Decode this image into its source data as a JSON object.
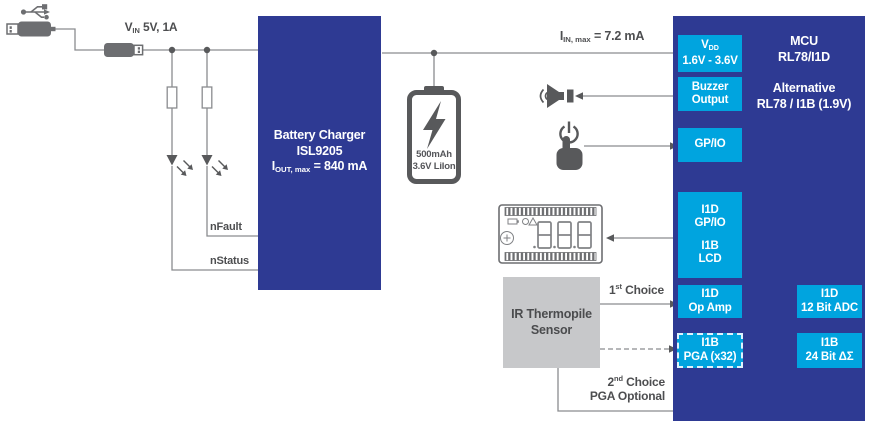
{
  "colors": {
    "block_blue": "#2e3a93",
    "accent_cyan": "#00a4df",
    "sensor_gray": "#c7c8ca",
    "wire_gray": "#8a8c8f",
    "icon_gray": "#58595b",
    "label_gray": "#4d4e50"
  },
  "input": {
    "vin_base": "V",
    "vin_sub": "IN",
    "vin_rest": " 5V, 1A"
  },
  "rail": {
    "iin_base": "I",
    "iin_sub": "IN, max",
    "iin_rest": " = 7.2 mA"
  },
  "charger": {
    "title": "Battery Charger",
    "part": "ISL9205",
    "iout_base": "I",
    "iout_sub": "OUT, max",
    "iout_rest": " = 840 mA",
    "nfault": "nFault",
    "nstatus": "nStatus"
  },
  "battery": {
    "capacity": "500mAh",
    "chemistry": "3.6V LiIon"
  },
  "mcu": {
    "title": "MCU",
    "part": "RL78/I1D",
    "alt_label": "Alternative",
    "alt_part": "RL78 / I1B (1.9V)",
    "vdd_base": "V",
    "vdd_sub": "DD",
    "vdd_range": "1.6V - 3.6V",
    "buzzer_l1": "Buzzer",
    "buzzer_l2": "Output",
    "gpio": "GP/IO",
    "lcd_l1": "I1D",
    "lcd_l2": "GP/IO",
    "lcd_l3": "I1B",
    "lcd_l4": "LCD",
    "opamp_l1": "I1D",
    "opamp_l2": "Op Amp",
    "adc_l1": "I1D",
    "adc_l2": "12 Bit ADC",
    "pga_l1": "I1B",
    "pga_l2": "PGA (x32)",
    "dsm_l1": "I1B",
    "dsm_l2": "24 Bit ΔΣ"
  },
  "sensor": {
    "l1": "IR Thermopile",
    "l2": "Sensor"
  },
  "choices": {
    "first_num": "1",
    "first_sup": "st",
    "first_rest": " Choice",
    "second_num": "2",
    "second_sup": "nd",
    "second_rest": " Choice",
    "pga_optional": "PGA Optional"
  }
}
